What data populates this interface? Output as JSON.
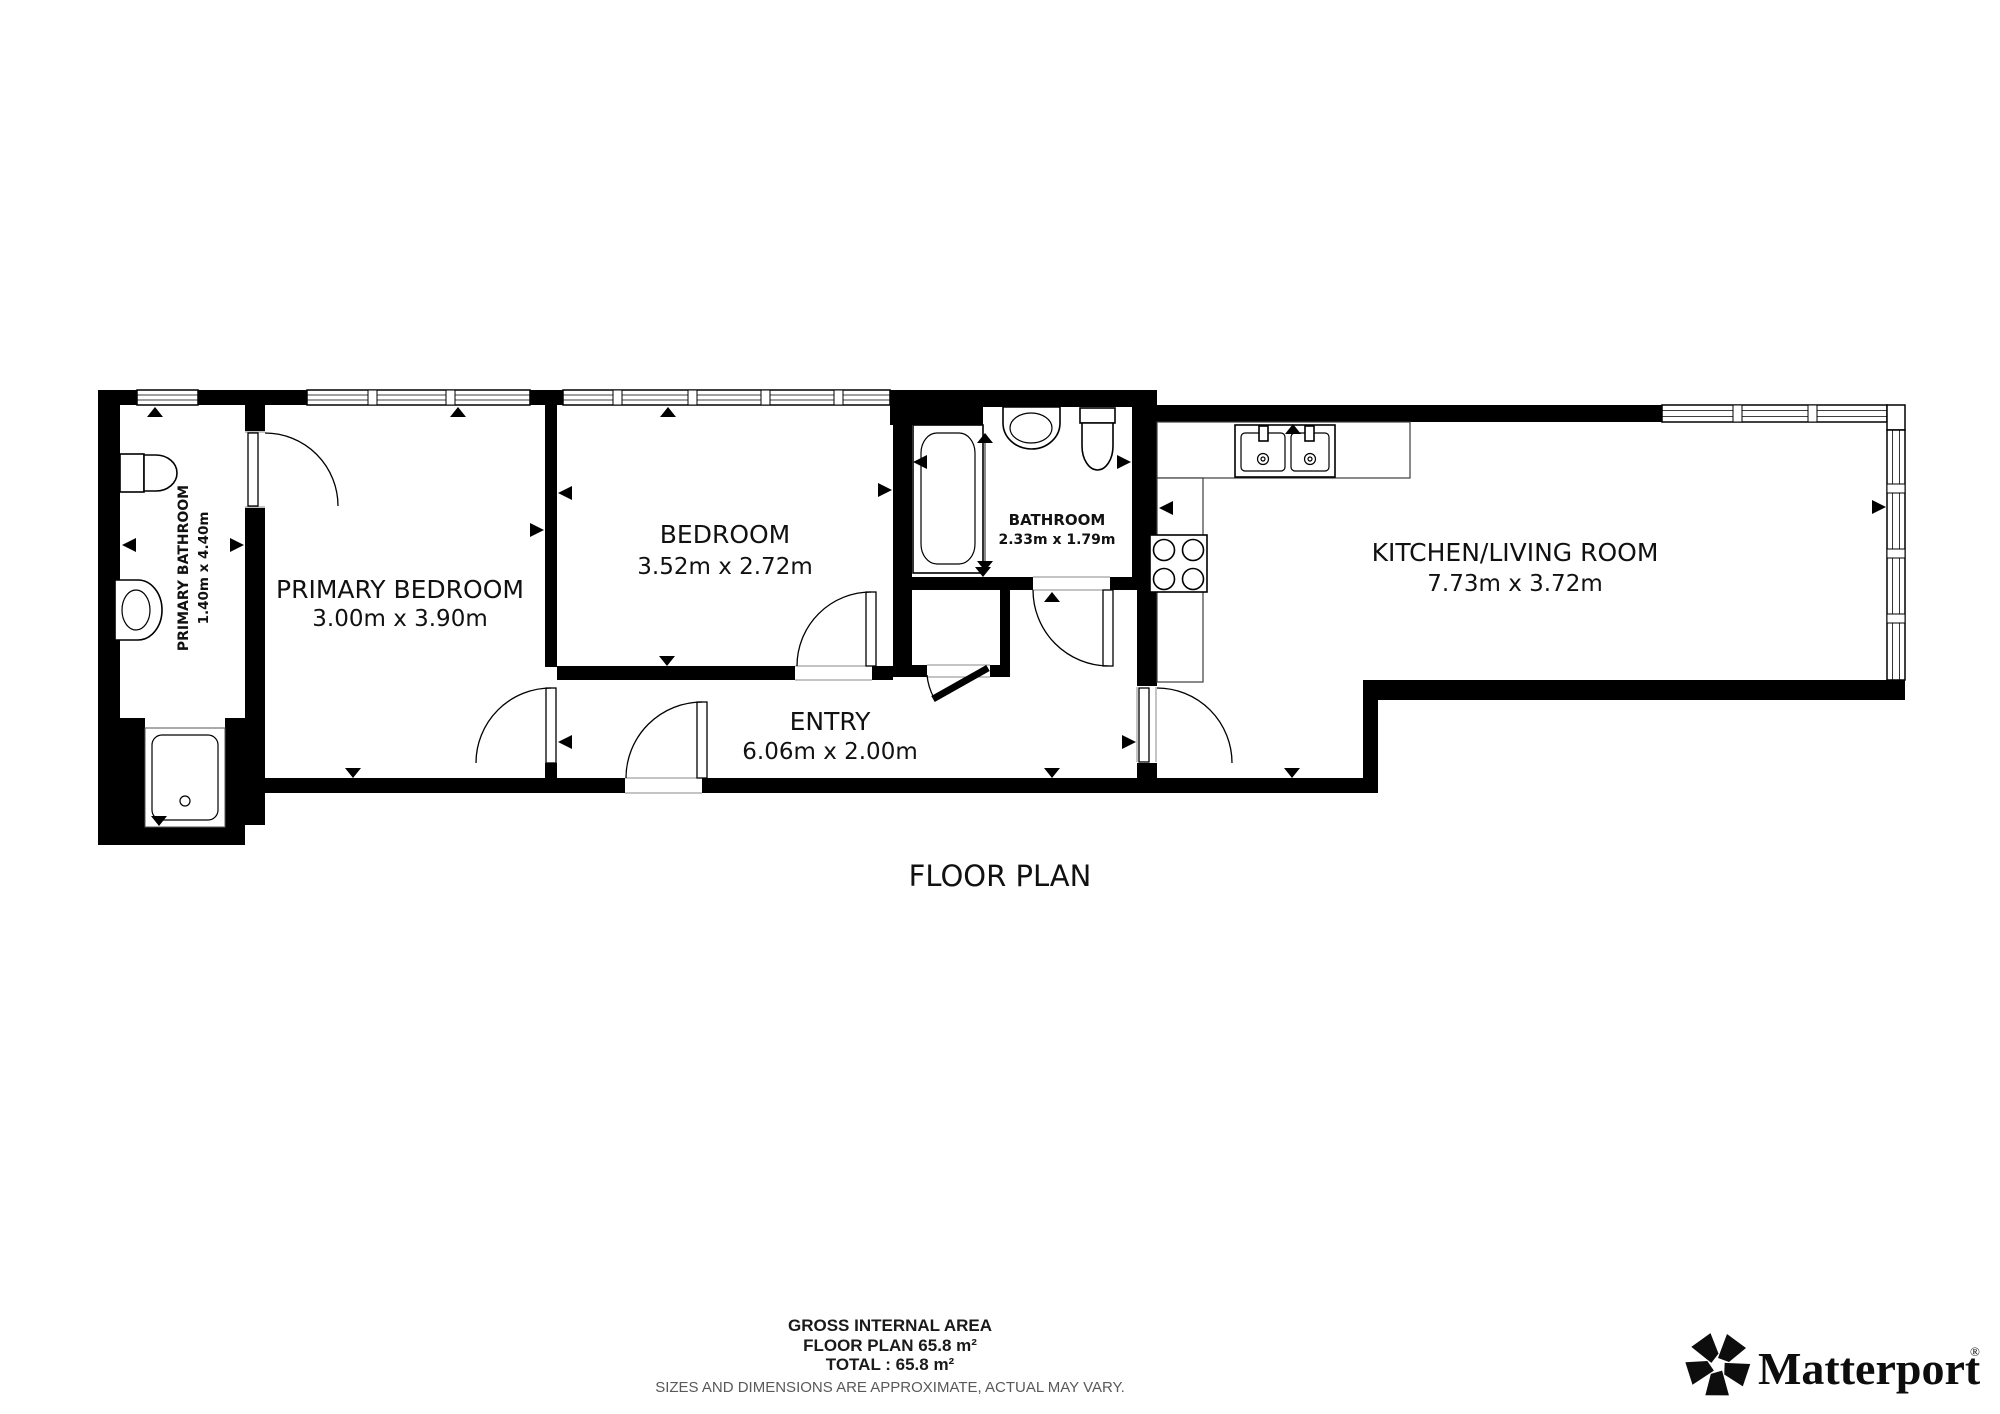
{
  "plan": {
    "title": "FLOOR PLAN",
    "rooms": [
      {
        "id": "primary-bathroom",
        "name": "PRIMARY BATHROOM",
        "dims": "1.40m x 4.40m"
      },
      {
        "id": "primary-bedroom",
        "name": "PRIMARY BEDROOM",
        "dims": "3.00m x 3.90m"
      },
      {
        "id": "bedroom",
        "name": "BEDROOM",
        "dims": "3.52m x 2.72m"
      },
      {
        "id": "bathroom",
        "name": "BATHROOM",
        "dims": "2.33m x 1.79m"
      },
      {
        "id": "entry",
        "name": "ENTRY",
        "dims": "6.06m x 2.00m"
      },
      {
        "id": "kitchen-living-room",
        "name": "KITCHEN/LIVING ROOM",
        "dims": "7.73m x 3.72m"
      }
    ],
    "fixtures": [
      "bathtub",
      "shower",
      "toilet",
      "sink",
      "double-sink",
      "stove",
      "kitchen-counter"
    ],
    "colors": {
      "wall": "#000000",
      "background": "#ffffff",
      "disclaimer_text": "#595959",
      "counter_outline": "#3c3c3c"
    }
  },
  "footer": {
    "area_title": "GROSS INTERNAL AREA",
    "floor_area": "FLOOR PLAN 65.8 m²",
    "total_area": "TOTAL :  65.8 m²",
    "disclaimer": "SIZES AND DIMENSIONS ARE APPROXIMATE, ACTUAL MAY VARY."
  },
  "brand": {
    "name": "Matterport",
    "registered": "®"
  }
}
